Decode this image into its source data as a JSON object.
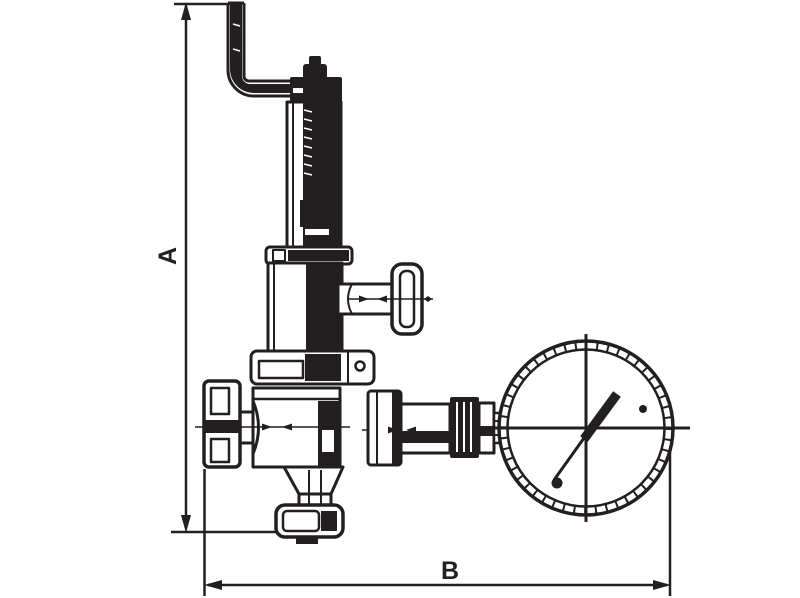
{
  "diagram": {
    "kind": "technical-line-drawing",
    "subject": "pressure-reducing-valve-with-gauge",
    "parts": [
      "top-pipe-elbow",
      "adjusting-spindle",
      "bonnet-tube",
      "spring-chamber",
      "side-t-handle",
      "body-flange",
      "valve-body",
      "inlet-union",
      "outlet-fittings",
      "bottom-outlet-flange",
      "pressure-gauge"
    ]
  },
  "labels": {
    "dimension_a": "A",
    "dimension_b": "B"
  },
  "colors": {
    "ink": "#231f20",
    "background": "#ffffff"
  }
}
